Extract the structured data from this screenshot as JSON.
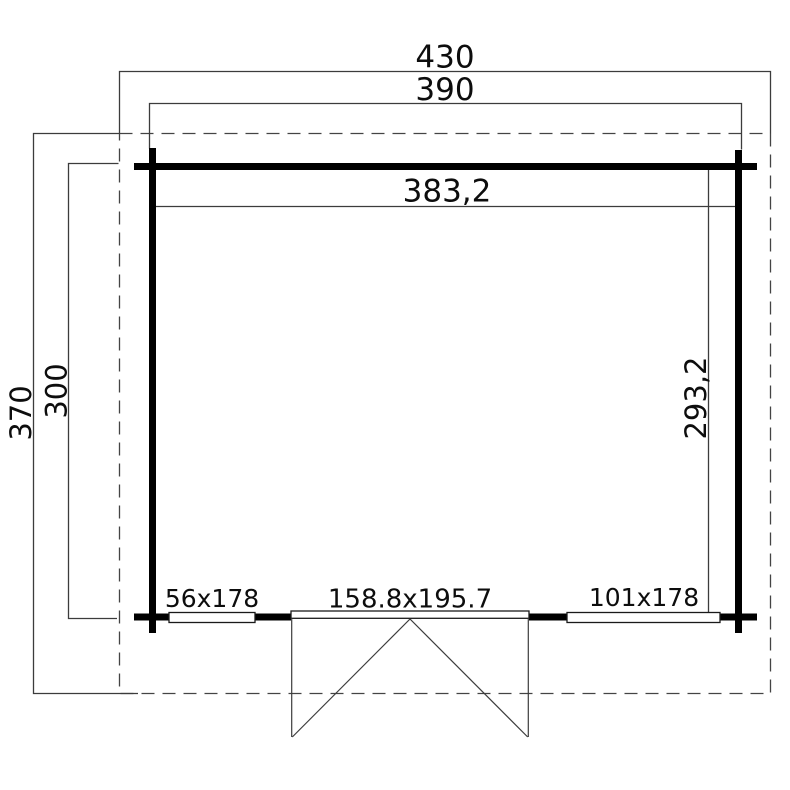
{
  "drawing_title": "log-cabin-floor-plan",
  "dimensions": {
    "total_width": "430",
    "outer_wall_width": "390",
    "inner_width": "383,2",
    "total_depth": "370",
    "outer_wall_depth": "300",
    "inner_depth": "293,2"
  },
  "openings": {
    "window_left": "56x178",
    "door": "158.8x195.7",
    "window_right": "101x178"
  },
  "colors": {
    "background": "#ffffff",
    "wall": "#000000",
    "dimension_line": "#3c3c3c",
    "roof_outline": "#444444",
    "text": "#0d0d0d"
  }
}
